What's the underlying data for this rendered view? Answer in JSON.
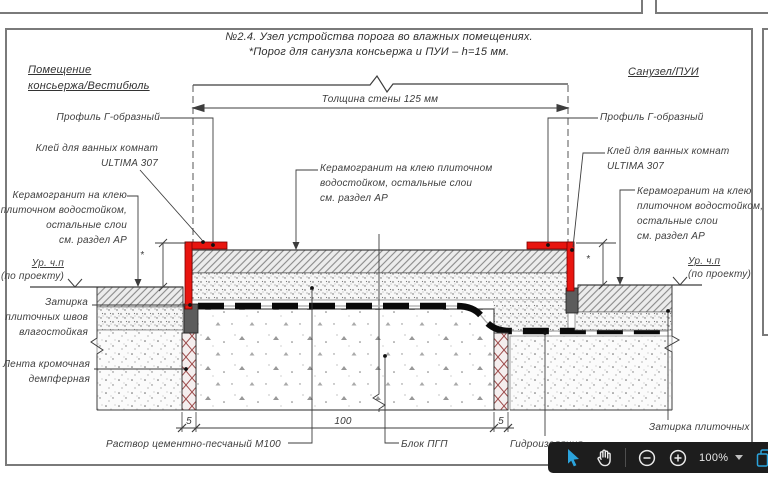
{
  "page": {
    "title_line1": "№2.4. Узел устройства порога во влажных помещениях.",
    "title_line2": "*Порог для санузла консьержа и ПУИ – h=15 мм."
  },
  "rooms": {
    "left_line1": "Помещение",
    "left_line2": "консьержа/Вестибюль",
    "right": "Санузел/ПУИ"
  },
  "dims": {
    "wall": "Толщина стены 125 мм",
    "left": "5",
    "center": "100",
    "right": "5",
    "star_left": "*",
    "star_right": "*"
  },
  "labels": {
    "profile_left": "Профиль Г-образный",
    "profile_right": "Профиль Г-образный",
    "glue_left_1": "Клей для ванных комнат",
    "glue_left_2": "ULTIMA 307",
    "glue_right_1": "Клей для ванных комнат",
    "glue_right_2": "ULTIMA 307",
    "ceramic_left_1": "Керамогранит на клею",
    "ceramic_left_2": "плиточном водостойком,",
    "ceramic_left_3": "остальные слои",
    "ceramic_left_4": "см. раздел АР",
    "ceramic_center_1": "Керамогранит на клею плиточном",
    "ceramic_center_2": "водостойком, остальные слои",
    "ceramic_center_3": "см. раздел АР",
    "ceramic_right_1": "Керамогранит на клею",
    "ceramic_right_2": "плиточном водостойком,",
    "ceramic_right_3": "остальные слои",
    "ceramic_right_4": "см. раздел АР",
    "level_left_1": "Ур. ч.п",
    "level_left_2": "(по проекту)",
    "level_right_1": "Ур. ч.п",
    "level_right_2": "(по проекту)",
    "grout_left_1": "Затирка",
    "grout_left_2": "плиточных швов",
    "grout_left_3": "влагостойкая",
    "tape_1": "Лента кромочная",
    "tape_2": "демпферная",
    "mortar": "Раствор цементно-песчаный М100",
    "block": "Блок ПГП",
    "waterproofing": "Гидроизоляция",
    "grout_right": "Затирка плиточных"
  },
  "toolbar": {
    "zoom_level": "100%",
    "icons": [
      "select-cursor",
      "pan-hand",
      "zoom-out",
      "zoom-in",
      "zoom-dropdown",
      "copy-pages"
    ]
  },
  "colors": {
    "accent_blue": "#2ba3dc",
    "profile_red": "#e8150f",
    "toolbar_bg": "#1d1d1d",
    "frame_gray": "#7a7a7a",
    "tape_red": "#9c4a4a",
    "ink": "#3d3d3d"
  }
}
